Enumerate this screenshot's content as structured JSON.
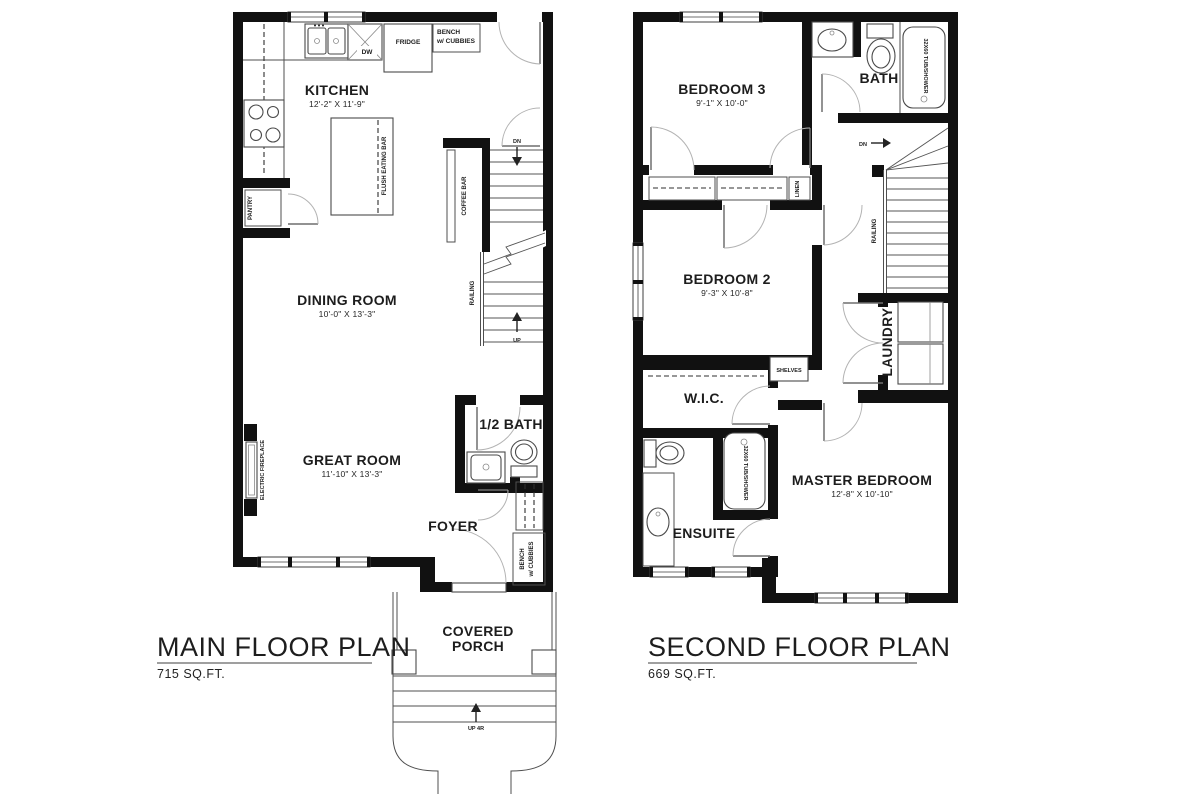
{
  "main_floor": {
    "title": "MAIN FLOOR PLAN",
    "area": "715 SQ.FT.",
    "kitchen": {
      "name": "KITCHEN",
      "dims": "12'-2\" X 11'-9\""
    },
    "dining_room": {
      "name": "DINING ROOM",
      "dims": "10'-0\" X 13'-3\""
    },
    "great_room": {
      "name": "GREAT ROOM",
      "dims": "11'-10\" X 13'-3\""
    },
    "half_bath": "1/2 BATH",
    "foyer": "FOYER",
    "covered_porch": {
      "line1": "COVERED",
      "line2": "PORCH"
    },
    "fridge": "FRIDGE",
    "dishwasher": "DW",
    "bench_cubbies": {
      "line1": "BENCH",
      "line2": "w/ CUBBIES"
    },
    "pantry": "PANTRY",
    "flush_eating_bar": "FLUSH EATING BAR",
    "coffee_bar": "COFFEE BAR",
    "railing": "RAILING",
    "electric_fireplace": "ELECTRIC FIREPLACE",
    "dn": "DN",
    "up": "UP",
    "up_4r": "UP 4R"
  },
  "second_floor": {
    "title": "SECOND FLOOR PLAN",
    "area": "669 SQ.FT.",
    "bedroom3": {
      "name": "BEDROOM 3",
      "dims": "9'-1\" X 10'-0\""
    },
    "bedroom2": {
      "name": "BEDROOM 2",
      "dims": "9'-3\" X 10'-8\""
    },
    "master": {
      "name": "MASTER BEDROOM",
      "dims": "12'-8\" X 10'-10\""
    },
    "bath": "BATH",
    "ensuite": "ENSUITE",
    "wic": "W.I.C.",
    "laundry": "LAUNDRY",
    "linen": "LINEN",
    "shelves": "SHELVES",
    "railing": "RAILING",
    "tub_shower": "32X60 TUB/SHOWER",
    "dn": "DN"
  },
  "colors": {
    "wall": "#111111",
    "background": "#ffffff",
    "line": "#4f4f4f"
  }
}
